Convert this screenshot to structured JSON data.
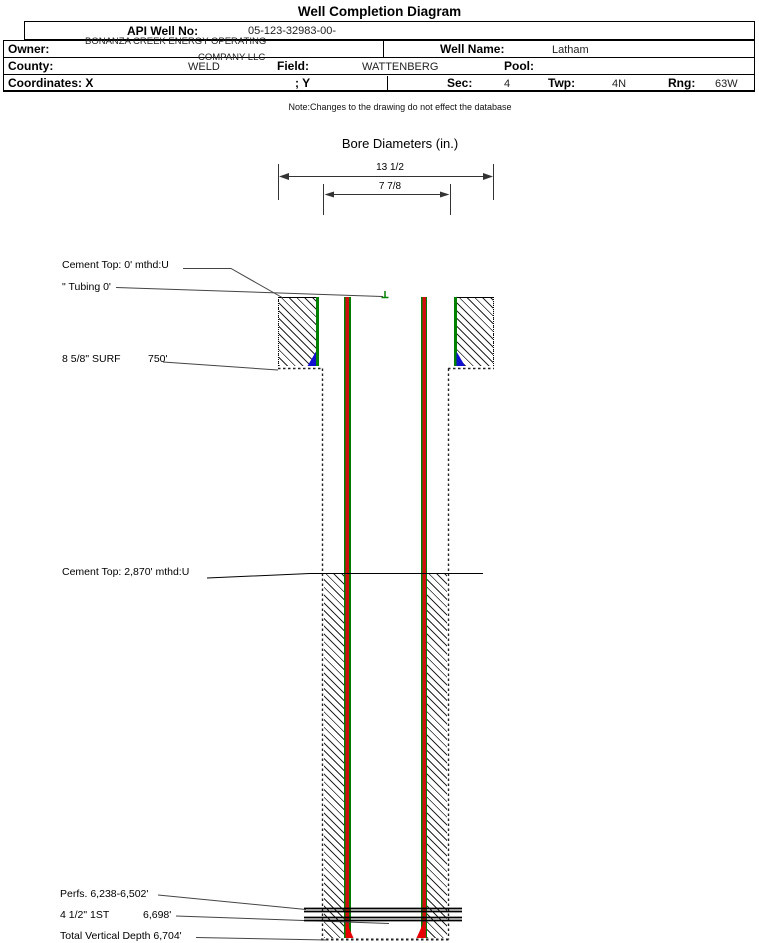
{
  "page": {
    "title": "Well Completion Diagram",
    "note": "Note:Changes to the drawing do not effect the database"
  },
  "header": {
    "api_label": "API Well No:",
    "api_value": "05-123-32983-00-",
    "owner_label": "Owner:",
    "owner_line1": "BONANZA CREEK ENERGY OPERATING",
    "owner_line2": "COMPANY LLC",
    "well_name_label": "Well Name:",
    "well_name": "Latham",
    "county_label": "County:",
    "county": "WELD",
    "field_label": "Field:",
    "field": "WATTENBERG",
    "pool_label": "Pool:",
    "pool": "",
    "coordinates_label": "Coordinates: X",
    "coordinates_y": "; Y",
    "sec_label": "Sec:",
    "sec": "4",
    "twp_label": "Twp:",
    "twp": "4N",
    "rng_label": "Rng:",
    "rng": "63W"
  },
  "bore": {
    "title": "Bore Diameters (in.)",
    "outer": "13 1/2",
    "inner": "7 7/8"
  },
  "annotations": {
    "cement_top_surface": "Cement Top: 0' mthd:U",
    "tubing": "\" Tubing 0'",
    "surf_casing": "8 5/8\" SURF",
    "surf_depth": "750'",
    "cement_top_prod": "Cement Top: 2,870' mthd:U",
    "perfs": "Perfs. 6,238-6,502'",
    "prod_casing": "4 1/2\" 1ST",
    "prod_depth": "6,698'",
    "tvd": "Total Vertical Depth 6,704'"
  },
  "colors": {
    "casing_green": "#008000",
    "casing_red": "#d01010",
    "surface_shoe_blue": "#1010d0",
    "production_shoe_red": "#e80000",
    "hatch": "#000000"
  }
}
